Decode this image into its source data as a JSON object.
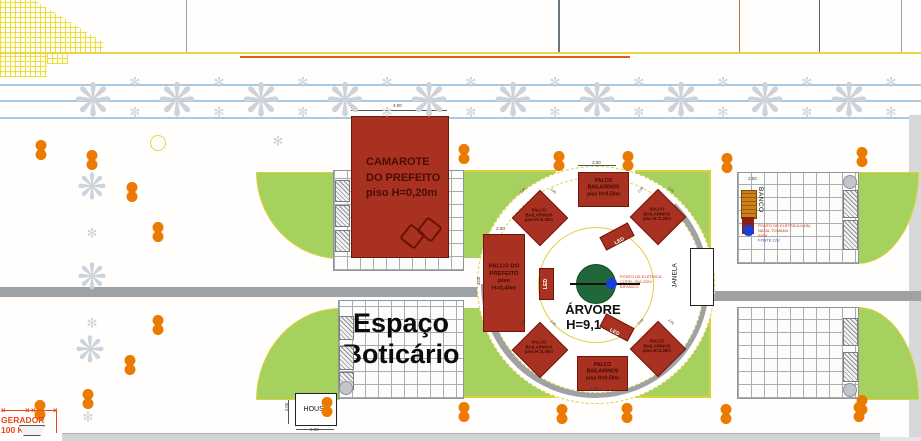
{
  "labels": {
    "camarote": "CAMAROTE\nDO PREFEITO\npiso H=0,20m",
    "palco_prefeito": "PALCO DO\nPREFEITO\npiso H=0,40m",
    "palco_50": "PALCO\nBAILARINOS\npiso H=0,50m",
    "palco_30": "PALCO\nBAILARINOS\npiso H=0,30m",
    "arvore": "ÁRVORE\nH=9,10m",
    "espaco": "Espaço\nBoticário",
    "banco": "BANCO",
    "janela": "JANELA",
    "house": "HOUSE",
    "gerador": "GERADOR\n100 KVA",
    "led": "LED",
    "elec_tree": "PONTO DE ELÉTRICA\nCOPEL 50A 220V\nBIFÁSICO",
    "elec_banco_1": "PONTO DE ELÉTRICA ILUM. NATAL TOMADA",
    "elec_banco_2": "220V",
    "elec_banco_3": "FONTE 12V"
  },
  "icons": {
    "street_tree": "❋",
    "small_flake": "✻"
  },
  "colors": {
    "stage_red": "#a93122",
    "stage_border": "#731409",
    "stage_text": "#3f0a03",
    "tree_green": "#20683a",
    "lawn_green": "#a6d15f",
    "lawn_edge": "#d9d23a",
    "ring_yellow": "#e2ce3f",
    "path_gray": "#9fa2a5",
    "flake_gray": "#cdd3da",
    "bollard_orange": "#ea7a00",
    "elec_red": "#d03614",
    "elec_blue": "#3344cc",
    "gerador_red": "#e8491c",
    "road_blue": "#aac9e2",
    "bench_brown": "#d08018",
    "hatch_yellow": "#eedc28",
    "dot_blue": "#1a3fd4"
  },
  "sprites": {
    "orange_dots": [
      [
        41,
        150
      ],
      [
        92,
        160
      ],
      [
        132,
        192
      ],
      [
        158,
        232
      ],
      [
        158,
        325
      ],
      [
        130,
        365
      ],
      [
        464,
        154
      ],
      [
        559,
        161
      ],
      [
        628,
        161
      ],
      [
        727,
        163
      ],
      [
        862,
        157
      ],
      [
        862,
        405
      ],
      [
        40,
        410
      ],
      [
        88,
        399
      ],
      [
        327,
        407
      ],
      [
        464,
        412
      ],
      [
        562,
        414
      ],
      [
        627,
        413
      ],
      [
        726,
        414
      ],
      [
        859,
        412
      ]
    ],
    "road_trees_x": [
      93,
      177,
      261,
      345,
      429,
      513,
      597,
      681,
      765,
      849
    ],
    "road_tree_y": 100,
    "road_flakes_x": [
      135,
      219,
      303,
      387,
      471,
      555,
      639,
      723,
      807,
      891
    ],
    "road_flake_rows": [
      82,
      112
    ],
    "area_trees": [
      [
        92,
        187
      ],
      [
        92,
        277
      ],
      [
        90,
        350
      ]
    ],
    "area_flakes": [
      [
        92,
        233
      ],
      [
        92,
        323
      ],
      [
        278,
        141
      ],
      [
        88,
        417
      ]
    ],
    "yellow_circles": [
      [
        157,
        142
      ]
    ],
    "hatch_rects": [
      [
        335,
        180,
        13,
        20
      ],
      [
        335,
        205,
        13,
        20
      ],
      [
        335,
        230,
        13,
        20
      ],
      [
        339,
        316,
        13,
        22
      ],
      [
        339,
        346,
        13,
        22
      ],
      [
        339,
        372,
        13,
        16
      ],
      [
        843,
        190,
        13,
        26
      ],
      [
        843,
        220,
        13,
        28
      ],
      [
        843,
        318,
        13,
        26
      ],
      [
        843,
        352,
        13,
        28
      ]
    ],
    "gray_circles": [
      [
        849,
        181
      ],
      [
        849,
        389
      ],
      [
        345,
        387
      ]
    ],
    "diamonds": [
      [
        539,
        217
      ],
      [
        657,
        216
      ],
      [
        539,
        349
      ],
      [
        657,
        348
      ]
    ],
    "diamond_dim": "2.00",
    "dims": [
      [
        "4.00",
        392,
        103,
        0
      ],
      [
        "2.00",
        591,
        160,
        0
      ],
      [
        "2.00",
        589,
        386,
        0
      ],
      [
        "2.00",
        495,
        226,
        0
      ],
      [
        "4.00",
        474,
        278,
        -90
      ],
      [
        "2.00",
        282,
        404,
        -90
      ],
      [
        "2.00",
        309,
        427,
        0
      ],
      [
        "2.00",
        747,
        176,
        0
      ]
    ],
    "x_marks": [
      [
        1,
        406
      ],
      [
        25,
        406
      ],
      [
        31,
        406
      ],
      [
        53,
        406
      ]
    ]
  }
}
